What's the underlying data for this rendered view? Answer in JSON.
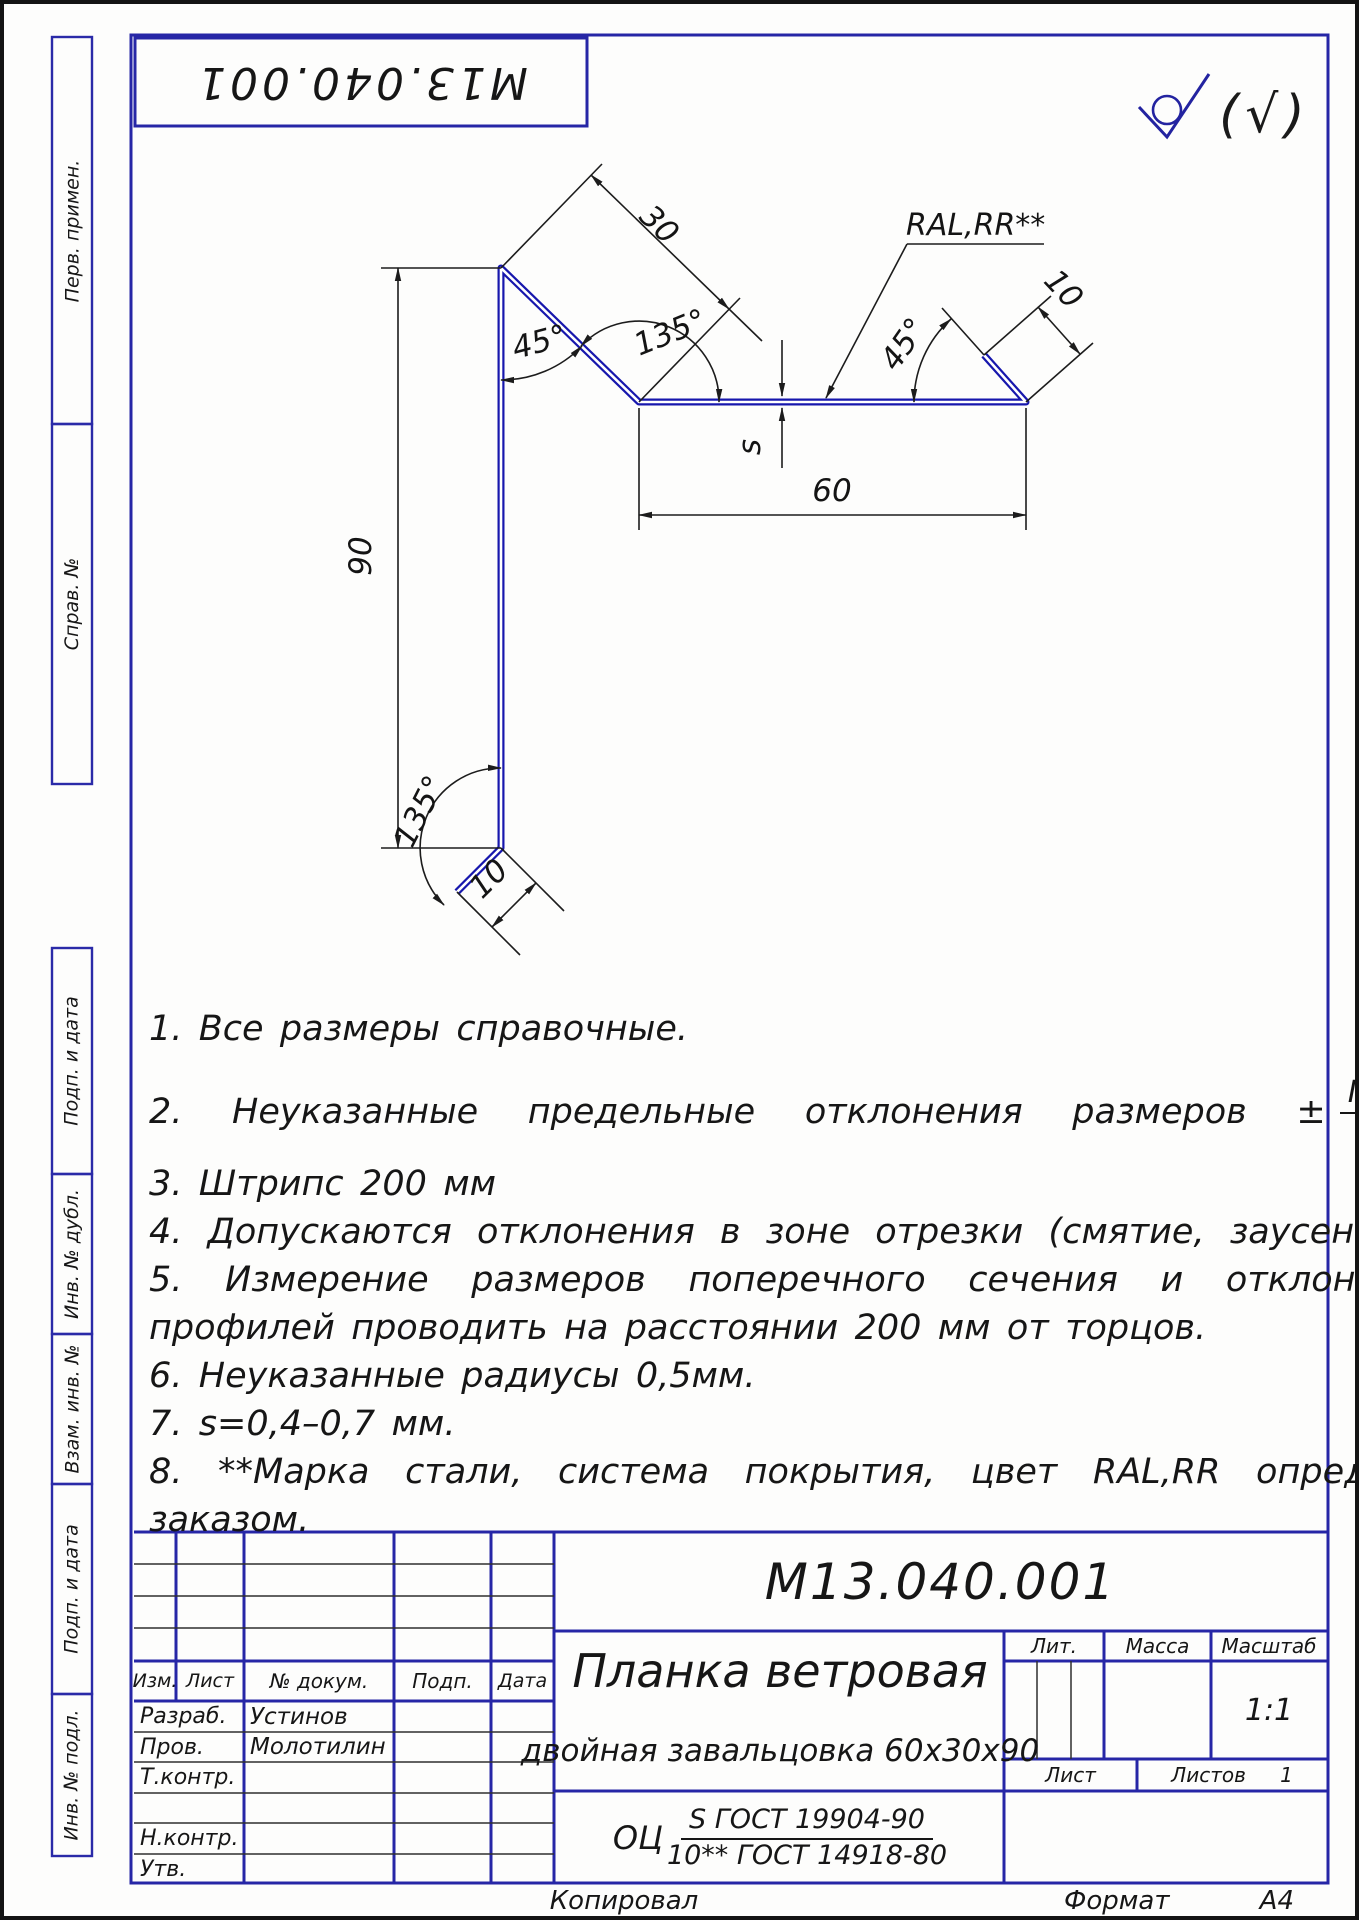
{
  "page": {
    "designation_top_rotated": "М13.040.001",
    "roughness_note": "(√)",
    "footer": {
      "copied_by": "Копировал",
      "format_label": "Формат",
      "format_value": "А4"
    }
  },
  "margin_labels": [
    "Перв. примен.",
    "Справ. №",
    "Подп. и дата",
    "Инв. № дубл.",
    "Взам. инв. №",
    "Подп. и дата",
    "Инв. № подл."
  ],
  "drawing": {
    "dim_30": "30",
    "angle_135_top": "135°",
    "angle_45_top": "45°",
    "dim_90": "90",
    "thickness_s": "s",
    "dim_60": "60",
    "coating_callout": "RAL,RR**",
    "angle_45_right": "45°",
    "dim_10_right": "10",
    "angle_135_bottom": "135°",
    "dim_10_bottom": "10"
  },
  "notes": {
    "line1": "1.  Все размеры справочные.",
    "line2_prefix": "2.  Неуказанные предельные отклонения размеров ±",
    "line2_frac_num": "IT14",
    "line2_frac_den": "2",
    "line2_suffix": ".",
    "line3": "3.  Штрипс 200 мм",
    "line4": "4.  Допускаются отклонения в зоне отрезки (смятие, заусенцы).",
    "line5a": "5.  Измерение размеров поперечного сечения и отклонений формы",
    "line5b": "профилей проводить на расстоянии 200 мм от торцов.",
    "line6": "6.  Неуказанные радиусы 0,5мм.",
    "line7": "7.  s=0,4–0,7 мм.",
    "line8a": "8.  **Марка стали, система покрытия, цвет RAL,RR определяется",
    "line8b": "заказом."
  },
  "stamp": {
    "designation": "М13.040.001",
    "title_line1": "Планка ветровая",
    "title_line2": "двойная завальцовка 60х30х90",
    "material_prefix": "ОЦ",
    "material_num": "S ГОСТ 19904-90",
    "material_den": "10** ГОСТ 14918-80",
    "header": {
      "izm": "Изм.",
      "list": "Лист",
      "doc": "№ докум.",
      "podp": "Подп.",
      "data": "Дата"
    },
    "roles": [
      {
        "label": "Разраб.",
        "name": "Устинов"
      },
      {
        "label": "Пров.",
        "name": "Молотилин"
      },
      {
        "label": "Т.контр.",
        "name": ""
      },
      {
        "label": "",
        "name": ""
      },
      {
        "label": "Н.контр.",
        "name": ""
      },
      {
        "label": "Утв.",
        "name": ""
      }
    ],
    "lit_label": "Лит.",
    "mass_label": "Масса",
    "scale_label": "Масштаб",
    "scale_value": "1:1",
    "sheet_label": "Лист",
    "sheets_label": "Листов",
    "sheets_value": "1"
  }
}
